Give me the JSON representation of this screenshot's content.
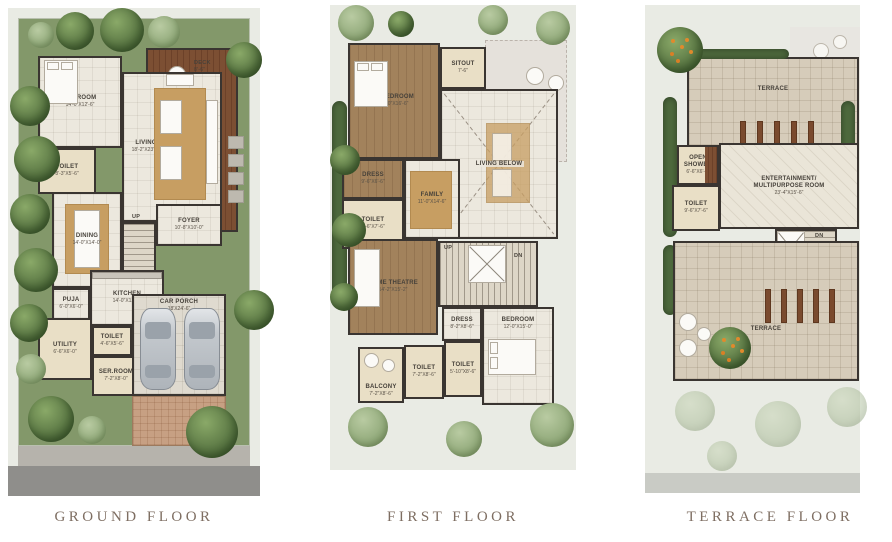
{
  "page": {
    "type": "architectural-floor-plans",
    "background": "#ffffff"
  },
  "colors": {
    "wall": "#3a3531",
    "floor_cream": "#ece8de",
    "floor_beige": "#e9dfc6",
    "carpet_brown": "#a2825c",
    "deck_wood": "#7c4f33",
    "terrace_tile": "#d6ccba",
    "grass": "#83986a",
    "tree_dark": "#5d7a46",
    "rug_tan": "#c79e62",
    "title_text": "#7e6e62",
    "road": "#8f8e8b",
    "driveway_brick": "#c7a083"
  },
  "floors": [
    {
      "title": "GROUND FLOOR",
      "labels": {
        "deck": "DECK",
        "deck_dims": "8'-6\"",
        "up": "UP"
      },
      "rooms": [
        {
          "name": "BEDROOM",
          "dims": "14'-0\"X12'-6\""
        },
        {
          "name": "TOILET",
          "dims": "8'-3\"X5'-6\""
        },
        {
          "name": "LIVING",
          "dims": "18'-2\"X23'-0\""
        },
        {
          "name": "DINING",
          "dims": "14'-0\"X14'-0\""
        },
        {
          "name": "FOYER",
          "dims": "10'-8\"X10'-0\""
        },
        {
          "name": "PUJA",
          "dims": "6'-0\"X6'-0\""
        },
        {
          "name": "KITCHEN",
          "dims": "14'-0\"X12'-0\""
        },
        {
          "name": "UTILITY",
          "dims": "6'-6\"X6'-0\""
        },
        {
          "name": "TOILET",
          "dims": "4'-6\"X5'-6\""
        },
        {
          "name": "SER.ROOM",
          "dims": "7'-2\"X8'-0\""
        },
        {
          "name": "CAR PORCH",
          "dims": "18'X24'-6\""
        }
      ]
    },
    {
      "title": "FIRST FLOOR",
      "labels": {
        "up": "UP",
        "dn": "DN",
        "living_below": "LIVING BELOW"
      },
      "rooms": [
        {
          "name": "M.BEDROOM",
          "dims": "14'-0\"X16'-6\""
        },
        {
          "name": "SITOUT",
          "dims": "7'-6\""
        },
        {
          "name": "DRESS",
          "dims": "9'-6\"X6'-6\""
        },
        {
          "name": "FAMILY",
          "dims": "11'-0\"X14'-6\""
        },
        {
          "name": "TOILET",
          "dims": "9'-6\"X7'-6\""
        },
        {
          "name": "HOME THEATRE",
          "dims": "14'-2\"X15'-2\""
        },
        {
          "name": "DRESS",
          "dims": "8'-2\"X8'-6\""
        },
        {
          "name": "BEDROOM",
          "dims": "12'-0\"X15'-0\""
        },
        {
          "name": "BALCONY",
          "dims": "7'-2\"X8'-6\""
        },
        {
          "name": "TOILET",
          "dims": "7'-2\"X8'-6\""
        },
        {
          "name": "TOILET",
          "dims": "5'-10\"X8'-6\""
        }
      ]
    },
    {
      "title": "TERRACE FLOOR",
      "labels": {
        "dn": "DN",
        "terrace": "TERRACE"
      },
      "rooms": [
        {
          "name": "OPEN SHOWER",
          "dims": "6'-6\"X6'-6\""
        },
        {
          "name": "TOILET",
          "dims": "9'-6\"X7'-6\""
        },
        {
          "name": "ENTERTAINMENT/ MULTIPURPOSE ROOM",
          "dims": "23'-4\"X15'-6\""
        }
      ]
    }
  ]
}
